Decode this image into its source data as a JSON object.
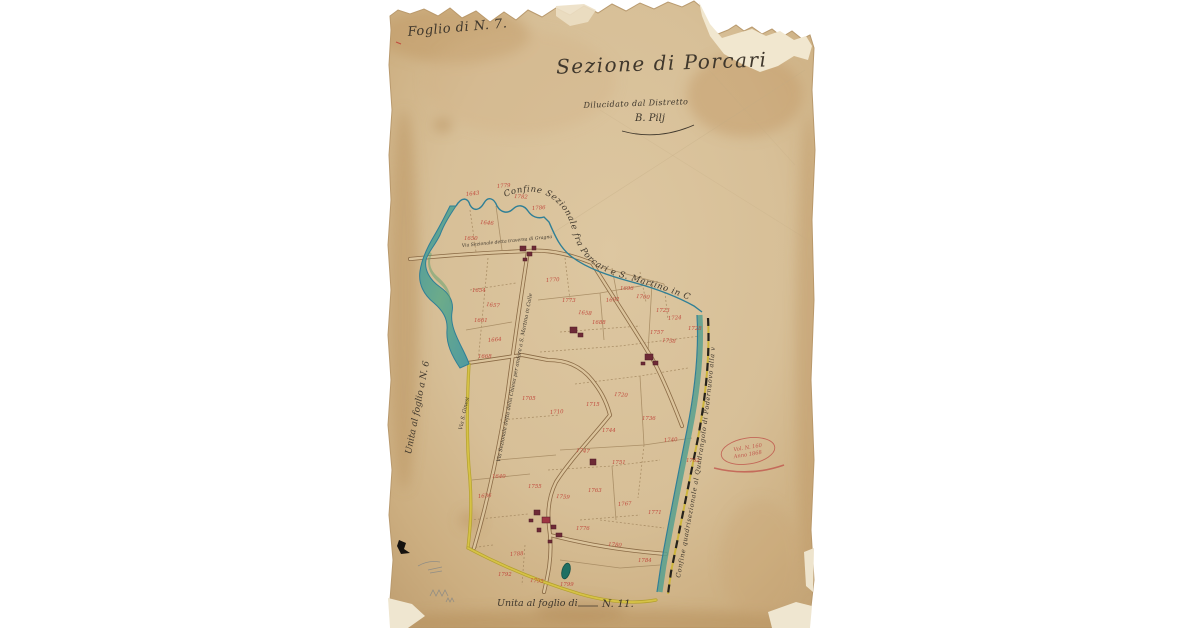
{
  "document": {
    "kind": "Hand-drawn cadastral map sheet (scanned, torn aged paper)",
    "sheet_label": "Foglio di N. 7.",
    "title": "Sezione di Porcari",
    "subtitle": "Dilucidato dal Distretto",
    "signature": "B. Pilj",
    "left_edge_note": "Unita al foglio a N. 6",
    "bottom_note": "Unita al foglio di",
    "bottom_note_number": "N. 11."
  },
  "map": {
    "boundary_top_label": "Confine Sezionale fra Porcari e S. Martino in Colle",
    "boundary_right_label": "Confine quadrisezionale al Quadrangolo di Podernuovo alla via alla posta",
    "road_labels": [
      {
        "name": "Via Sezionale detta traversa di Gragnano"
      },
      {
        "name": "Via Sezionale detta della Chiesa per andare a S. Martino in Colle"
      },
      {
        "name": "Via S. Ginesi"
      }
    ],
    "stamp": {
      "line1": "Vol. N. 160",
      "line2": "Anno 1868"
    },
    "parcel_numbers": [
      {
        "v": "1643",
        "x": 466,
        "y": 196,
        "r": -6
      },
      {
        "v": "1646",
        "x": 480,
        "y": 224,
        "r": 4
      },
      {
        "v": "1650",
        "x": 464,
        "y": 240,
        "r": 0
      },
      {
        "v": "1779",
        "x": 497,
        "y": 188,
        "r": -5
      },
      {
        "v": "1782",
        "x": 514,
        "y": 198,
        "r": 3
      },
      {
        "v": "1786",
        "x": 532,
        "y": 210,
        "r": -4
      },
      {
        "v": "1654",
        "x": 472,
        "y": 292,
        "r": 0
      },
      {
        "v": "1657",
        "x": 486,
        "y": 306,
        "r": 6
      },
      {
        "v": "1661",
        "x": 474,
        "y": 322,
        "r": 0
      },
      {
        "v": "1664",
        "x": 488,
        "y": 342,
        "r": -5
      },
      {
        "v": "1668",
        "x": 478,
        "y": 358,
        "r": 0
      },
      {
        "v": "1770",
        "x": 546,
        "y": 282,
        "r": -4
      },
      {
        "v": "1773",
        "x": 562,
        "y": 302,
        "r": 0
      },
      {
        "v": "1658",
        "x": 578,
        "y": 314,
        "r": 5
      },
      {
        "v": "1688",
        "x": 592,
        "y": 324,
        "r": 0
      },
      {
        "v": "1692",
        "x": 606,
        "y": 302,
        "r": -5
      },
      {
        "v": "1696",
        "x": 620,
        "y": 290,
        "r": 0
      },
      {
        "v": "1700",
        "x": 636,
        "y": 298,
        "r": 4
      },
      {
        "v": "1723",
        "x": 656,
        "y": 312,
        "r": 0
      },
      {
        "v": "1724",
        "x": 668,
        "y": 320,
        "r": -4
      },
      {
        "v": "1757",
        "x": 650,
        "y": 334,
        "r": 0
      },
      {
        "v": "1758",
        "x": 662,
        "y": 342,
        "r": 4
      },
      {
        "v": "1728",
        "x": 688,
        "y": 330,
        "r": 0
      },
      {
        "v": "1705",
        "x": 522,
        "y": 400,
        "r": 0
      },
      {
        "v": "1710",
        "x": 550,
        "y": 414,
        "r": -4
      },
      {
        "v": "1715",
        "x": 586,
        "y": 406,
        "r": 0
      },
      {
        "v": "1720",
        "x": 614,
        "y": 396,
        "r": 4
      },
      {
        "v": "1736",
        "x": 642,
        "y": 420,
        "r": 0
      },
      {
        "v": "1740",
        "x": 664,
        "y": 442,
        "r": -4
      },
      {
        "v": "1744",
        "x": 602,
        "y": 432,
        "r": 0
      },
      {
        "v": "1747",
        "x": 576,
        "y": 452,
        "r": 4
      },
      {
        "v": "1751",
        "x": 612,
        "y": 464,
        "r": 0
      },
      {
        "v": "1762",
        "x": 686,
        "y": 462,
        "r": 0
      },
      {
        "v": "1640",
        "x": 492,
        "y": 478,
        "r": 0
      },
      {
        "v": "1636",
        "x": 478,
        "y": 498,
        "r": -4
      },
      {
        "v": "1755",
        "x": 528,
        "y": 488,
        "r": 0
      },
      {
        "v": "1759",
        "x": 556,
        "y": 498,
        "r": 4
      },
      {
        "v": "1763",
        "x": 588,
        "y": 492,
        "r": 0
      },
      {
        "v": "1767",
        "x": 618,
        "y": 506,
        "r": -4
      },
      {
        "v": "1771",
        "x": 648,
        "y": 514,
        "r": 0
      },
      {
        "v": "1776",
        "x": 576,
        "y": 530,
        "r": 0
      },
      {
        "v": "1780",
        "x": 608,
        "y": 546,
        "r": 4
      },
      {
        "v": "1784",
        "x": 638,
        "y": 562,
        "r": 0
      },
      {
        "v": "1788",
        "x": 510,
        "y": 556,
        "r": -4
      },
      {
        "v": "1792",
        "x": 498,
        "y": 576,
        "r": 0
      },
      {
        "v": "1795",
        "x": 530,
        "y": 582,
        "r": 4
      },
      {
        "v": "1799",
        "x": 560,
        "y": 586,
        "r": 0
      }
    ]
  },
  "colors": {
    "background": "#ffffff",
    "paper_base": "#d9c29c",
    "paper_edge": "#c2a274",
    "paper_light_patch": "#f1e7cf",
    "ink": "#3f372c",
    "parcel_red": "#c14b3e",
    "stamp_red": "#c0584d",
    "stream_line": "#2f7f96",
    "stream_fill": "#66a98c",
    "road_edge": "#8a6a45",
    "road_fill": "#dbc49c",
    "yellow_road": "#cdb53c",
    "building": "#6e2a36"
  }
}
